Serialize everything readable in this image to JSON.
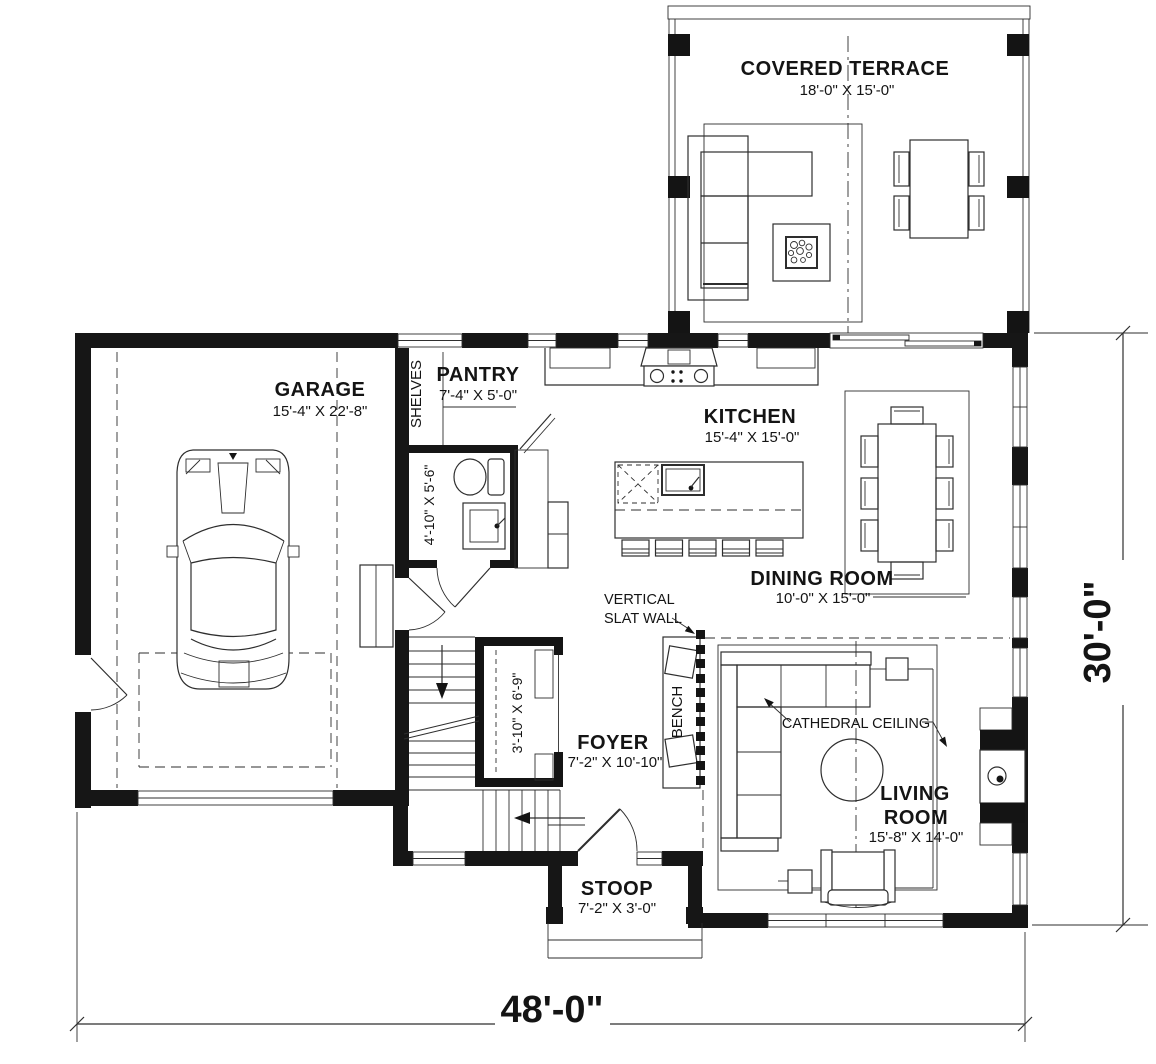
{
  "plan": {
    "rooms": {
      "terrace": {
        "name": "COVERED TERRACE",
        "dim": "18'-0\" X 15'-0\""
      },
      "garage": {
        "name": "GARAGE",
        "dim": "15'-4\" X 22'-8\""
      },
      "pantry": {
        "name": "PANTRY",
        "dim": "7'-4\" X 5'-0\""
      },
      "kitchen": {
        "name": "KITCHEN",
        "dim": "15'-4\" X 15'-0\""
      },
      "dining_room": {
        "name": "DINING ROOM",
        "dim": "10'-0\" X 15'-0\""
      },
      "foyer": {
        "name": "FOYER",
        "dim": "7'-2\" X 10'-10\""
      },
      "living_room": {
        "name_line1": "LIVING",
        "name_line2": "ROOM",
        "dim": "15'-8\" X 14'-0\""
      },
      "stoop": {
        "name": "STOOP",
        "dim": "7'-2\" X 3'-0\""
      },
      "bathroom": {
        "dim": "4'-10\" X 5'-6\""
      },
      "closet": {
        "dim": "3'-10\" X 6'-9\""
      }
    },
    "annotations": {
      "shelves": "SHELVES",
      "bench": "BENCH",
      "slat_wall_line1": "VERTICAL",
      "slat_wall_line2": "SLAT WALL",
      "cathedral_ceiling": "CATHEDRAL CEILING"
    },
    "overall_dimensions": {
      "width": "48'-0\"",
      "depth": "30'-0\""
    },
    "colors": {
      "wall": "#161616",
      "line": "#2e2e2e",
      "background": "#ffffff"
    }
  }
}
